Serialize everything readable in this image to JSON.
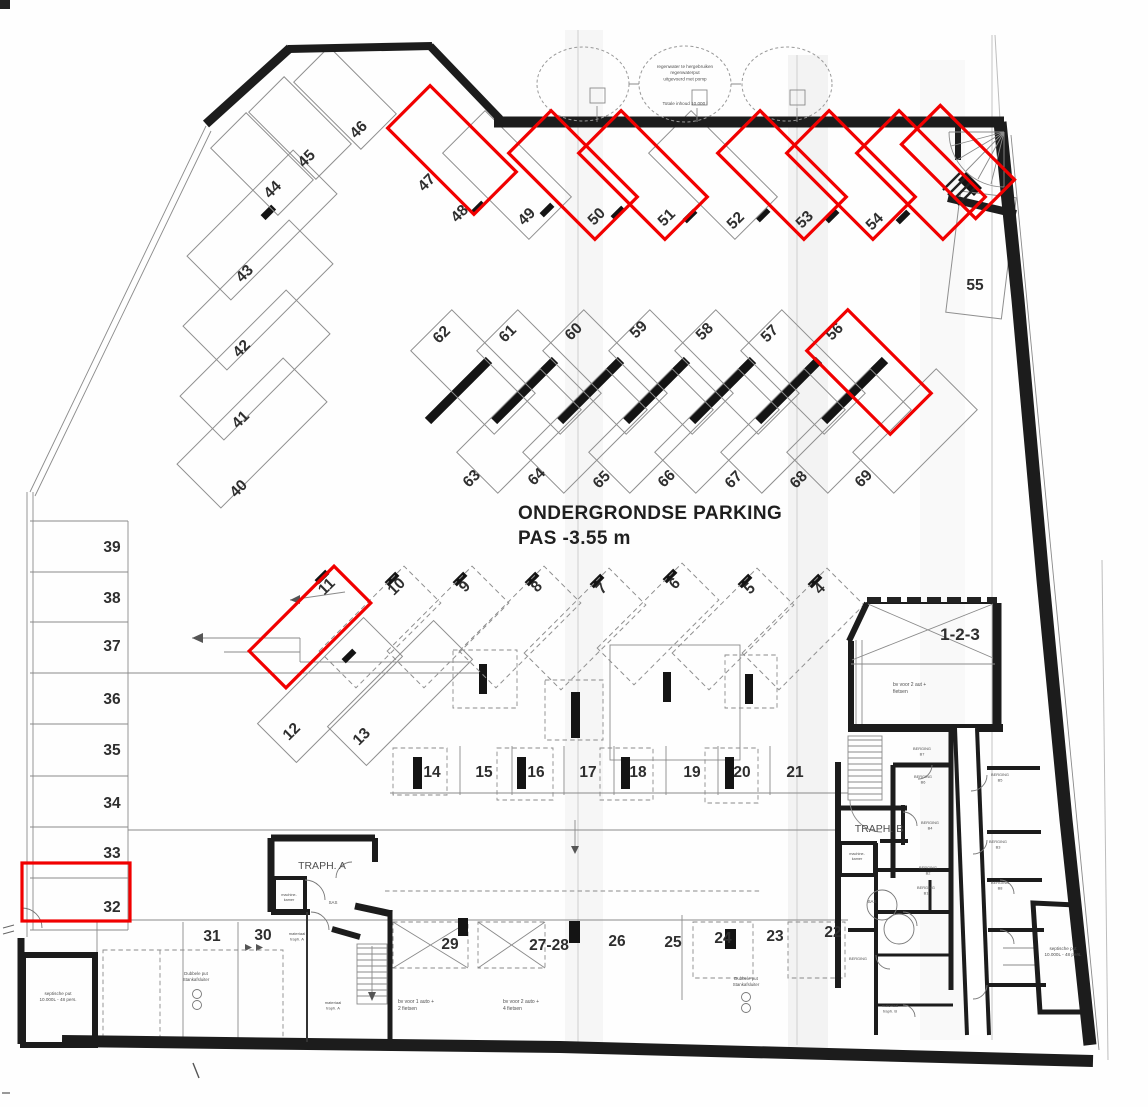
{
  "title": {
    "line1": "ONDERGRONDSE PARKING",
    "line2": "PAS -3.55 m"
  },
  "colors": {
    "highlight": "#f10000",
    "wall": "#1c1c1c",
    "thin_line": "#8a8a8a",
    "number": "#2e2e2e",
    "paper": "#fefefe"
  },
  "tank": {
    "lines": [
      "regenwater te hergebruiken",
      "regenwaterput",
      "uitgevoerd met pomp"
    ],
    "note": "Totale inhoud 10.000 l"
  },
  "spots": [
    {
      "n": "44",
      "lx": 276,
      "ly": 193,
      "lr": -45,
      "rect": {
        "cx": 262,
        "cy": 164,
        "l": 95,
        "w": 50,
        "r": 45,
        "s": "thin"
      }
    },
    {
      "n": "45",
      "lx": 310,
      "ly": 162,
      "lr": -45,
      "rect": {
        "cx": 300,
        "cy": 128,
        "l": 95,
        "w": 50,
        "r": 45,
        "s": "thin"
      }
    },
    {
      "n": "46",
      "lx": 362,
      "ly": 133,
      "lr": -45,
      "rect": {
        "cx": 345,
        "cy": 98,
        "l": 95,
        "w": 50,
        "r": 45,
        "s": "thin"
      }
    },
    {
      "n": "43",
      "lx": 248,
      "ly": 277,
      "lr": -45,
      "rect": {
        "cx": 262,
        "cy": 225,
        "l": 150,
        "w": 62,
        "r": -45,
        "s": "thin"
      }
    },
    {
      "n": "42",
      "lx": 245,
      "ly": 352,
      "lr": -45,
      "rect": {
        "cx": 258,
        "cy": 295,
        "l": 150,
        "w": 62,
        "r": -45,
        "s": "thin"
      }
    },
    {
      "n": "41",
      "lx": 244,
      "ly": 423,
      "lr": -45,
      "rect": {
        "cx": 255,
        "cy": 365,
        "l": 150,
        "w": 62,
        "r": -45,
        "s": "thin"
      }
    },
    {
      "n": "40",
      "lx": 242,
      "ly": 492,
      "lr": -45,
      "rect": {
        "cx": 252,
        "cy": 433,
        "l": 150,
        "w": 62,
        "r": -45,
        "s": "thin"
      }
    },
    {
      "n": "47",
      "lx": 430,
      "ly": 186,
      "lr": -45,
      "rect": {
        "cx": 452,
        "cy": 150,
        "l": 122,
        "w": 60,
        "r": 45,
        "s": "red"
      }
    },
    {
      "n": "48",
      "lx": 463,
      "ly": 217,
      "lr": -45,
      "rect": {
        "cx": 507,
        "cy": 175,
        "l": 122,
        "w": 60,
        "r": 45,
        "s": "thin"
      }
    },
    {
      "n": "49",
      "lx": 530,
      "ly": 220,
      "lr": -45,
      "rect": {
        "cx": 573,
        "cy": 175,
        "l": 122,
        "w": 60,
        "r": 45,
        "s": "red"
      }
    },
    {
      "n": "50",
      "lx": 600,
      "ly": 220,
      "lr": -45,
      "rect": {
        "cx": 643,
        "cy": 175,
        "l": 122,
        "w": 60,
        "r": 45,
        "s": "red"
      }
    },
    {
      "n": "51",
      "lx": 670,
      "ly": 221,
      "lr": -45,
      "rect": {
        "cx": 713,
        "cy": 175,
        "l": 122,
        "w": 60,
        "r": 45,
        "s": "thin"
      }
    },
    {
      "n": "52",
      "lx": 739,
      "ly": 224,
      "lr": -45,
      "rect": {
        "cx": 782,
        "cy": 175,
        "l": 122,
        "w": 60,
        "r": 45,
        "s": "red"
      }
    },
    {
      "n": "53",
      "lx": 808,
      "ly": 223,
      "lr": -45,
      "rect": {
        "cx": 851,
        "cy": 175,
        "l": 122,
        "w": 60,
        "r": 45,
        "s": "red"
      }
    },
    {
      "n": "54",
      "lx": 878,
      "ly": 225,
      "lr": -45,
      "rect": {
        "cx": 921,
        "cy": 175,
        "l": 122,
        "w": 60,
        "r": 45,
        "s": "red"
      }
    },
    {
      "n": "",
      "lx": 0,
      "ly": 0,
      "lr": 0,
      "rect": {
        "cx": 958,
        "cy": 162,
        "l": 105,
        "w": 55,
        "r": 45,
        "s": "red"
      }
    },
    {
      "n": "55",
      "lx": 975,
      "ly": 290,
      "lr": 0,
      "rect": {
        "cx": 981,
        "cy": 255,
        "l": 122,
        "w": 56,
        "r": 97,
        "s": "thin"
      }
    },
    {
      "n": "62",
      "lx": 445,
      "ly": 338,
      "lr": -45,
      "rect": {
        "cx": 473,
        "cy": 372,
        "l": 118,
        "w": 58,
        "r": 45,
        "s": "thin"
      }
    },
    {
      "n": "61",
      "lx": 511,
      "ly": 337,
      "lr": -45,
      "rect": {
        "cx": 539,
        "cy": 372,
        "l": 118,
        "w": 58,
        "r": 45,
        "s": "thin"
      }
    },
    {
      "n": "60",
      "lx": 577,
      "ly": 335,
      "lr": -45,
      "rect": {
        "cx": 605,
        "cy": 372,
        "l": 118,
        "w": 58,
        "r": 45,
        "s": "thin"
      }
    },
    {
      "n": "59",
      "lx": 642,
      "ly": 333,
      "lr": -45,
      "rect": {
        "cx": 671,
        "cy": 372,
        "l": 118,
        "w": 58,
        "r": 45,
        "s": "thin"
      }
    },
    {
      "n": "58",
      "lx": 708,
      "ly": 335,
      "lr": -45,
      "rect": {
        "cx": 737,
        "cy": 372,
        "l": 118,
        "w": 58,
        "r": 45,
        "s": "thin"
      }
    },
    {
      "n": "57",
      "lx": 773,
      "ly": 337,
      "lr": -45,
      "rect": {
        "cx": 803,
        "cy": 372,
        "l": 118,
        "w": 58,
        "r": 45,
        "s": "thin"
      }
    },
    {
      "n": "56",
      "lx": 838,
      "ly": 335,
      "lr": -45,
      "rect": {
        "cx": 869,
        "cy": 372,
        "l": 118,
        "w": 58,
        "r": 45,
        "s": "red"
      }
    },
    {
      "n": "63",
      "lx": 475,
      "ly": 482,
      "lr": -45,
      "rect": {
        "cx": 519,
        "cy": 431,
        "l": 118,
        "w": 58,
        "r": -45,
        "s": "thin"
      }
    },
    {
      "n": "64",
      "lx": 540,
      "ly": 480,
      "lr": -45,
      "rect": {
        "cx": 585,
        "cy": 431,
        "l": 118,
        "w": 58,
        "r": -45,
        "s": "thin"
      }
    },
    {
      "n": "65",
      "lx": 605,
      "ly": 483,
      "lr": -45,
      "rect": {
        "cx": 651,
        "cy": 431,
        "l": 118,
        "w": 58,
        "r": -45,
        "s": "thin"
      }
    },
    {
      "n": "66",
      "lx": 670,
      "ly": 482,
      "lr": -45,
      "rect": {
        "cx": 717,
        "cy": 431,
        "l": 118,
        "w": 58,
        "r": -45,
        "s": "thin"
      }
    },
    {
      "n": "67",
      "lx": 737,
      "ly": 483,
      "lr": -45,
      "rect": {
        "cx": 783,
        "cy": 431,
        "l": 118,
        "w": 58,
        "r": -45,
        "s": "thin"
      }
    },
    {
      "n": "68",
      "lx": 802,
      "ly": 483,
      "lr": -45,
      "rect": {
        "cx": 849,
        "cy": 431,
        "l": 118,
        "w": 58,
        "r": -45,
        "s": "thin"
      }
    },
    {
      "n": "69",
      "lx": 867,
      "ly": 482,
      "lr": -45,
      "rect": {
        "cx": 915,
        "cy": 431,
        "l": 118,
        "w": 58,
        "r": -45,
        "s": "thin"
      }
    },
    {
      "n": "11",
      "lx": 330,
      "ly": 590,
      "lr": -45,
      "rect": {
        "cx": 310,
        "cy": 627,
        "l": 120,
        "w": 52,
        "r": -45,
        "s": "red"
      }
    },
    {
      "n": "10",
      "lx": 400,
      "ly": 590,
      "lr": -45,
      "rect": {
        "cx": 380,
        "cy": 627,
        "l": 120,
        "w": 52,
        "r": -45,
        "s": "dash"
      }
    },
    {
      "n": "9",
      "lx": 468,
      "ly": 590,
      "lr": -45,
      "rect": {
        "cx": 448,
        "cy": 627,
        "l": 120,
        "w": 52,
        "r": -45,
        "s": "dash"
      }
    },
    {
      "n": "8",
      "lx": 540,
      "ly": 590,
      "lr": -45,
      "rect": {
        "cx": 520,
        "cy": 627,
        "l": 120,
        "w": 52,
        "r": -45,
        "s": "dash"
      }
    },
    {
      "n": "7",
      "lx": 605,
      "ly": 592,
      "lr": -45,
      "rect": {
        "cx": 585,
        "cy": 629,
        "l": 120,
        "w": 52,
        "r": -45,
        "s": "dash"
      }
    },
    {
      "n": "6",
      "lx": 678,
      "ly": 587,
      "lr": -45,
      "rect": {
        "cx": 658,
        "cy": 624,
        "l": 120,
        "w": 52,
        "r": -45,
        "s": "dash"
      }
    },
    {
      "n": "5",
      "lx": 753,
      "ly": 592,
      "lr": -45,
      "rect": {
        "cx": 733,
        "cy": 629,
        "l": 120,
        "w": 52,
        "r": -45,
        "s": "dash"
      }
    },
    {
      "n": "4",
      "lx": 823,
      "ly": 592,
      "lr": -45,
      "rect": {
        "cx": 803,
        "cy": 629,
        "l": 120,
        "w": 52,
        "r": -45,
        "s": "dash"
      }
    },
    {
      "n": "12",
      "lx": 295,
      "ly": 735,
      "lr": -45,
      "rect": {
        "cx": 330,
        "cy": 690,
        "l": 150,
        "w": 55,
        "r": -45,
        "s": "thin"
      }
    },
    {
      "n": "13",
      "lx": 365,
      "ly": 740,
      "lr": -45,
      "rect": {
        "cx": 400,
        "cy": 693,
        "l": 150,
        "w": 55,
        "r": -45,
        "s": "thin"
      }
    },
    {
      "n": "39",
      "lx": 112,
      "ly": 552,
      "lr": 0
    },
    {
      "n": "38",
      "lx": 112,
      "ly": 603,
      "lr": 0
    },
    {
      "n": "37",
      "lx": 112,
      "ly": 651,
      "lr": 0
    },
    {
      "n": "36",
      "lx": 112,
      "ly": 704,
      "lr": 0
    },
    {
      "n": "35",
      "lx": 112,
      "ly": 755,
      "lr": 0
    },
    {
      "n": "34",
      "lx": 112,
      "ly": 808,
      "lr": 0
    },
    {
      "n": "33",
      "lx": 112,
      "ly": 858,
      "lr": 0
    },
    {
      "n": "32",
      "lx": 112,
      "ly": 912,
      "lr": 0,
      "rect": {
        "cx": 76,
        "cy": 892,
        "l": 108,
        "w": 58,
        "r": 0,
        "s": "red"
      }
    },
    {
      "n": "14",
      "lx": 432,
      "ly": 777,
      "lr": 0
    },
    {
      "n": "15",
      "lx": 484,
      "ly": 777,
      "lr": 0
    },
    {
      "n": "16",
      "lx": 536,
      "ly": 777,
      "lr": 0
    },
    {
      "n": "17",
      "lx": 588,
      "ly": 777,
      "lr": 0
    },
    {
      "n": "18",
      "lx": 638,
      "ly": 777,
      "lr": 0
    },
    {
      "n": "19",
      "lx": 692,
      "ly": 777,
      "lr": 0
    },
    {
      "n": "20",
      "lx": 742,
      "ly": 777,
      "lr": 0
    },
    {
      "n": "21",
      "lx": 795,
      "ly": 777,
      "lr": 0
    },
    {
      "n": "31",
      "lx": 212,
      "ly": 941,
      "lr": 0
    },
    {
      "n": "30",
      "lx": 263,
      "ly": 940,
      "lr": 0
    },
    {
      "n": "29",
      "lx": 450,
      "ly": 949,
      "lr": 0
    },
    {
      "n": "27-28",
      "lx": 549,
      "ly": 950,
      "lr": 0
    },
    {
      "n": "26",
      "lx": 617,
      "ly": 946,
      "lr": 0
    },
    {
      "n": "25",
      "lx": 673,
      "ly": 947,
      "lr": 0
    },
    {
      "n": "24",
      "lx": 723,
      "ly": 943,
      "lr": 0
    },
    {
      "n": "23",
      "lx": 775,
      "ly": 941,
      "lr": 0
    },
    {
      "n": "22",
      "lx": 833,
      "ly": 937,
      "lr": 0
    },
    {
      "n": "1-2-3",
      "lx": 960,
      "ly": 640,
      "lr": 0,
      "fs": 17
    }
  ],
  "texts": [
    {
      "x": 685,
      "y": 68,
      "s": 4.6,
      "lines": [
        "regenwater te hergebruiken",
        "regenwaterput",
        "uitgevoerd met pomp"
      ]
    },
    {
      "x": 685,
      "y": 105,
      "s": 4.6,
      "lines": [
        "Totale inhoud 10.000 l"
      ]
    },
    {
      "x": 893,
      "y": 686,
      "s": 5,
      "a": "s",
      "lines": [
        "bv voor 2 aut +",
        "fietsen"
      ]
    },
    {
      "x": 398,
      "y": 1003,
      "s": 5,
      "a": "s",
      "lines": [
        "bv voor 1 auto +",
        "2 fietsen"
      ]
    },
    {
      "x": 503,
      "y": 1003,
      "s": 5,
      "a": "s",
      "lines": [
        "bv voor 2 auto +",
        "4 fietsen"
      ]
    },
    {
      "x": 196,
      "y": 975,
      "s": 4.4,
      "lines": [
        "Dubbele put",
        "Stankafsluiter"
      ]
    },
    {
      "x": 746,
      "y": 980,
      "s": 4.4,
      "lines": [
        "Dubbele put",
        "Stankafsluiter"
      ]
    },
    {
      "x": 58,
      "y": 995,
      "s": 4.6,
      "lines": [
        "septische put",
        "10.000L - 48 pers."
      ]
    },
    {
      "x": 1063,
      "y": 950,
      "s": 4.6,
      "lines": [
        "septische put",
        "10.000L - 48 pers."
      ]
    },
    {
      "x": 322,
      "y": 869,
      "s": 10.5,
      "lines": [
        "TRAPH. A"
      ]
    },
    {
      "x": 879,
      "y": 832,
      "s": 10.5,
      "lines": [
        "TRAPH. B"
      ]
    },
    {
      "x": 297,
      "y": 935,
      "s": 4,
      "lines": [
        "materiaal",
        "traph. A"
      ]
    },
    {
      "x": 333,
      "y": 1004,
      "s": 4,
      "lines": [
        "materiaal",
        "traph. A"
      ]
    },
    {
      "x": 890,
      "y": 1007,
      "s": 4,
      "lines": [
        "materiaal",
        "traph. B"
      ]
    },
    {
      "x": 289,
      "y": 896,
      "s": 3.8,
      "lines": [
        "machine-",
        "kamer"
      ]
    },
    {
      "x": 857,
      "y": 855,
      "s": 3.8,
      "lines": [
        "machine-",
        "kamer"
      ]
    },
    {
      "x": 333,
      "y": 904,
      "s": 4.4,
      "lines": [
        "SAS"
      ]
    },
    {
      "x": 872,
      "y": 903,
      "s": 4.4,
      "lines": [
        "SAS"
      ]
    },
    {
      "x": 922,
      "y": 750,
      "s": 3.9,
      "lines": [
        "BERGING",
        "B7"
      ]
    },
    {
      "x": 923,
      "y": 778,
      "s": 3.9,
      "lines": [
        "BERGING",
        "B6"
      ]
    },
    {
      "x": 1000,
      "y": 776,
      "s": 3.9,
      "lines": [
        "BERGING",
        "B5"
      ]
    },
    {
      "x": 930,
      "y": 824,
      "s": 3.9,
      "lines": [
        "BERGING",
        "B4"
      ]
    },
    {
      "x": 998,
      "y": 843,
      "s": 3.9,
      "lines": [
        "BERGING",
        "B3"
      ]
    },
    {
      "x": 928,
      "y": 869,
      "s": 3.9,
      "lines": [
        "BERGING",
        "B2"
      ]
    },
    {
      "x": 926,
      "y": 889,
      "s": 3.9,
      "lines": [
        "BERGING",
        "B1"
      ]
    },
    {
      "x": 1000,
      "y": 884,
      "s": 3.9,
      "lines": [
        "BERGING",
        "B8"
      ]
    },
    {
      "x": 858,
      "y": 960,
      "s": 3.9,
      "lines": [
        "BERGING"
      ]
    }
  ]
}
